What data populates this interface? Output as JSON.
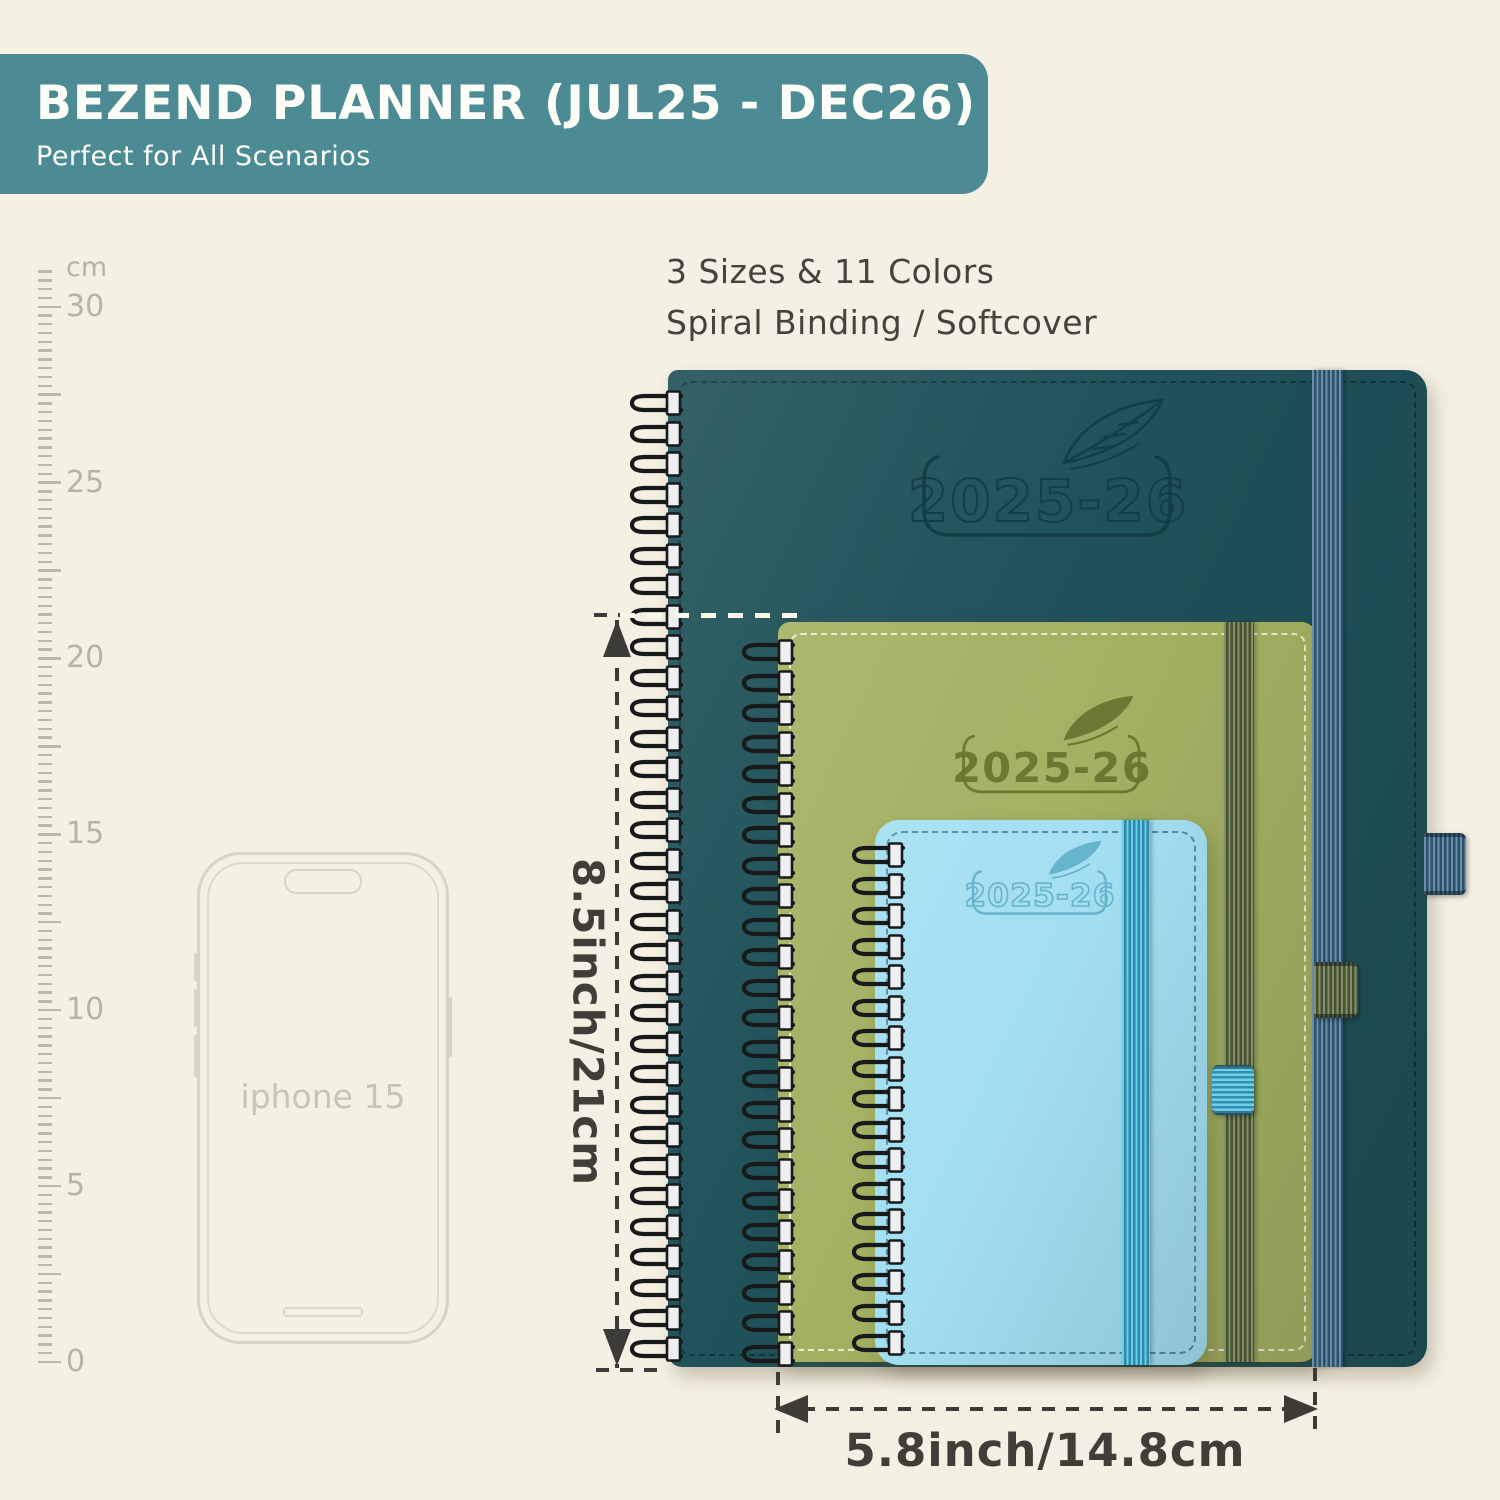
{
  "banner": {
    "title": "BEZEND PLANNER (JUL25 - DEC26)",
    "subtitle": "Perfect for All Scenarios"
  },
  "features": {
    "line1": "3 Sizes & 11 Colors",
    "line2": "Spiral Binding / Softcover"
  },
  "ruler": {
    "unit": "cm",
    "marks": [
      "30",
      "25",
      "20",
      "15",
      "10",
      "5",
      "0"
    ]
  },
  "phone": {
    "label": "iphone 15"
  },
  "planners": [
    {
      "name": "large-planner",
      "year_label": "2025-26"
    },
    {
      "name": "medium-planner",
      "year_label": "2025-26"
    },
    {
      "name": "small-planner",
      "year_label": "2025-26"
    }
  ],
  "dimensions": {
    "height_label": "8.5inch/21cm",
    "width_label": "5.8inch/14.8cm"
  },
  "colors": {
    "page-bg": "#f4f0e3",
    "banner-bg": "#4d8b94",
    "cover-large": "#1f5158",
    "cover-medium": "#a3b162",
    "cover-small": "#a3dff2",
    "band-large": "#3f6f92",
    "band-medium": "#5f7040",
    "band-small": "#3fc0e8",
    "dim-line": "#3c3b36"
  }
}
